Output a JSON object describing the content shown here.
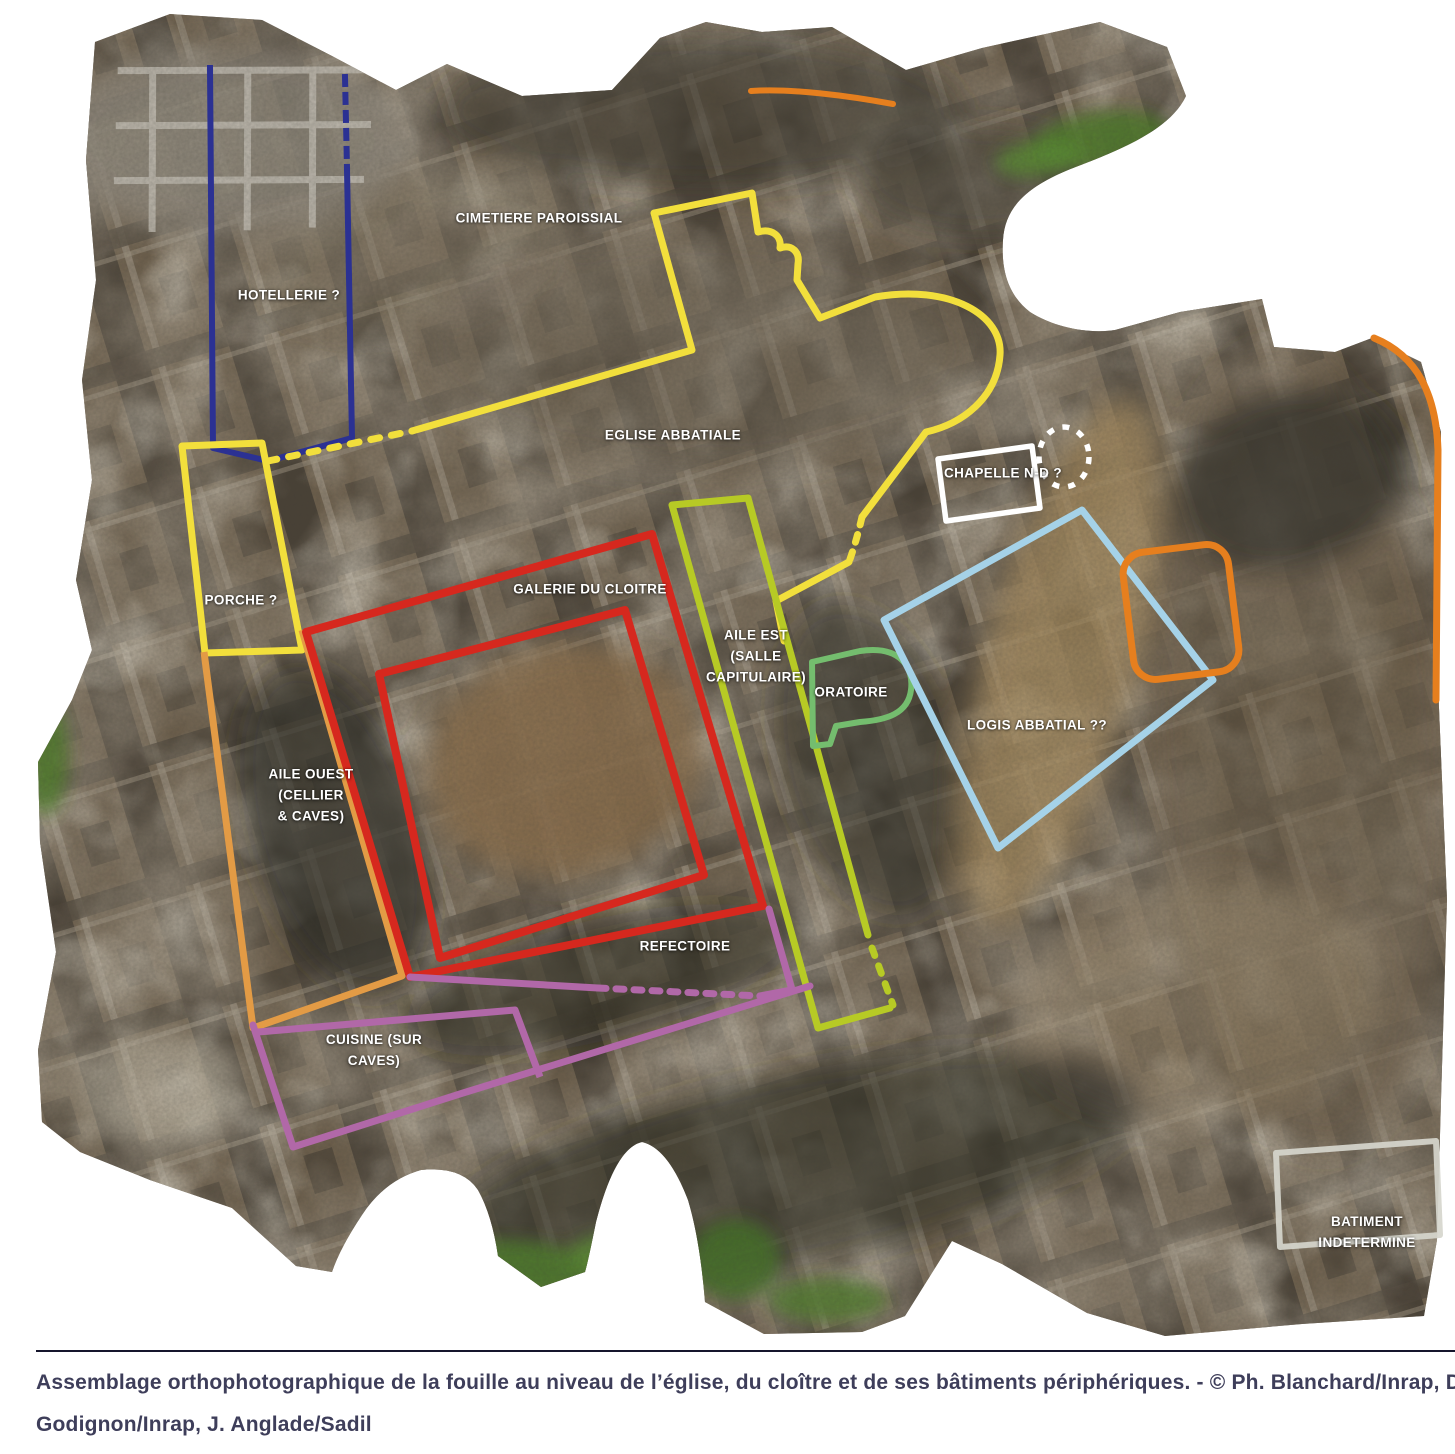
{
  "figure": {
    "type": "annotated-excavation-orthophoto",
    "areas": [
      {
        "id": "cimetiere-paroissial",
        "label": "CIMETIERE PAROISSIAL",
        "outline_color": null
      },
      {
        "id": "hotellerie",
        "label": "HOTELLERIE ?",
        "outline_color": "#2b3193"
      },
      {
        "id": "eglise-abbatiale",
        "label": "EGLISE ABBATIALE",
        "outline_color": "#f2df3c"
      },
      {
        "id": "chapelle-nd",
        "label": "CHAPELLE N-D ?",
        "outline_color": "#ffffff"
      },
      {
        "id": "porche",
        "label": "PORCHE ?",
        "outline_color": "#f2df3c"
      },
      {
        "id": "galerie-du-cloitre",
        "label": "GALERIE DU CLOITRE",
        "outline_color": "#d6281e"
      },
      {
        "id": "aile-est",
        "label": "AILE EST\n(SALLE\nCAPITULAIRE)",
        "outline_color": "#b7ca25"
      },
      {
        "id": "oratoire",
        "label": "ORATOIRE",
        "outline_color": "#74bd6e"
      },
      {
        "id": "logis-abbatial",
        "label": "LOGIS ABBATIAL ??",
        "outline_color": "#a5d2e8"
      },
      {
        "id": "aile-ouest",
        "label": "AILE OUEST\n(CELLIER\n& CAVES)",
        "outline_color": "#e39b45"
      },
      {
        "id": "refectoire",
        "label": "REFECTOIRE",
        "outline_color": "#b168a8"
      },
      {
        "id": "cuisine",
        "label": "CUISINE (SUR\nCAVES)",
        "outline_color": "#b168a8"
      },
      {
        "id": "batiment-indetermine",
        "label": "BATIMENT\nINDETERMINE",
        "outline_color": "#d6d6cd"
      }
    ],
    "unlabeled_outline_color": "#e67f1e"
  },
  "caption": {
    "line1": "Assemblage orthophotographique de la fouille au niveau de l’église, du cloître et de ses bâtiments périphériques. - © Ph. Blanchard/Inrap, D.",
    "line2": "Godignon/Inrap, J. Anglade/Sadil",
    "text_color": "#3e3e5a",
    "divider_color": "#15152c"
  }
}
